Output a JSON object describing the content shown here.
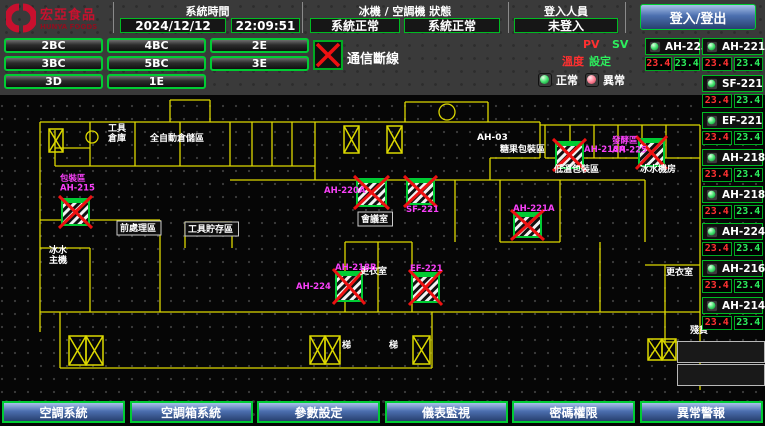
{
  "header": {
    "logo_title": "宏亞食品",
    "logo_subtitle": "HUNYA FOODS",
    "system_time_label": "系統時間",
    "date": "2024/12/12",
    "time": "22:09:51",
    "status_label": "冰機 / 空調機 狀態",
    "chiller_status": "系統正常",
    "ahu_status": "系統正常",
    "login_label": "登入人員",
    "login_status": "未登入",
    "login_button": "登入/登出"
  },
  "nav": {
    "rows": [
      [
        "2BC",
        "4BC",
        "2E"
      ],
      [
        "3BC",
        "5BC",
        "3E"
      ],
      [
        "3D",
        "1E"
      ]
    ]
  },
  "comm_loss_label": "通信斷線",
  "pvsv": {
    "pv": "PV",
    "sv": "SV",
    "temp": "溫度",
    "set": "設定"
  },
  "legend": {
    "normal": "正常",
    "abnormal": "異常"
  },
  "panel": {
    "left_unit": {
      "name": "AH-225",
      "pv": "23.4",
      "sv": "23.4"
    },
    "units": [
      {
        "name": "AH-221A",
        "pv": "23.4",
        "sv": "23.4"
      },
      {
        "name": "SF-221",
        "pv": "23.4",
        "sv": "23.4"
      },
      {
        "name": "EF-221",
        "pv": "23.4",
        "sv": "23.4"
      },
      {
        "name": "AH-218A",
        "pv": "23.4",
        "sv": "23.4"
      },
      {
        "name": "AH-218B",
        "pv": "23.4",
        "sv": "23.4"
      },
      {
        "name": "AH-224",
        "pv": "23.4",
        "sv": "23.4"
      },
      {
        "name": "AH-216",
        "pv": "23.4",
        "sv": "23.4"
      },
      {
        "name": "AH-214",
        "pv": "23.4",
        "sv": "23.4"
      }
    ],
    "empty_slots": 2
  },
  "floorplan": {
    "rooms": [
      {
        "text": "工具\n倉庫",
        "x": 108,
        "y": 131
      },
      {
        "text": "全自動倉儲區",
        "x": 150,
        "y": 141
      },
      {
        "text": "AH-03",
        "x": 477,
        "y": 140
      },
      {
        "text": "糖果包裝區",
        "x": 500,
        "y": 152
      },
      {
        "text": "低溫包裝區",
        "x": 554,
        "y": 172
      },
      {
        "text": "冰水機房",
        "x": 640,
        "y": 172
      },
      {
        "text": "會議室",
        "x": 361,
        "y": 222,
        "boxed": true
      },
      {
        "text": "前處理區",
        "x": 120,
        "y": 231,
        "boxed": true
      },
      {
        "text": "工具貯存區",
        "x": 188,
        "y": 232,
        "boxed": true
      },
      {
        "text": "冰水\n主機",
        "x": 49,
        "y": 253
      },
      {
        "text": "更衣室",
        "x": 360,
        "y": 274
      },
      {
        "text": "更衣室",
        "x": 666,
        "y": 275
      },
      {
        "text": "梯",
        "x": 342,
        "y": 348
      },
      {
        "text": "梯",
        "x": 389,
        "y": 348
      },
      {
        "text": "殘貨",
        "x": 690,
        "y": 333
      }
    ],
    "tags": [
      {
        "text": "包裝區\nAH-215",
        "x": 60,
        "y": 181
      },
      {
        "text": "AH-220A",
        "x": 324,
        "y": 193
      },
      {
        "text": "SF-221",
        "x": 406,
        "y": 212
      },
      {
        "text": "AH-218A",
        "x": 584,
        "y": 152
      },
      {
        "text": "發酵區\nAH-225",
        "x": 612,
        "y": 143
      },
      {
        "text": "AH-221A",
        "x": 513,
        "y": 211
      },
      {
        "text": "AH-224",
        "x": 296,
        "y": 289
      },
      {
        "text": "AH-218B",
        "x": 335,
        "y": 270
      },
      {
        "text": "EF-221",
        "x": 410,
        "y": 271
      }
    ],
    "units": [
      {
        "x": 62,
        "y": 199,
        "w": 27,
        "h": 26
      },
      {
        "x": 357,
        "y": 179,
        "w": 29,
        "h": 27
      },
      {
        "x": 407,
        "y": 179,
        "w": 27,
        "h": 25
      },
      {
        "x": 556,
        "y": 142,
        "w": 27,
        "h": 26
      },
      {
        "x": 639,
        "y": 139,
        "w": 25,
        "h": 27
      },
      {
        "x": 514,
        "y": 213,
        "w": 27,
        "h": 24
      },
      {
        "x": 336,
        "y": 272,
        "w": 26,
        "h": 29
      },
      {
        "x": 412,
        "y": 273,
        "w": 27,
        "h": 29
      }
    ],
    "stairs": [
      {
        "x": 49,
        "y": 129,
        "w": 14,
        "h": 23
      },
      {
        "x": 344,
        "y": 126,
        "w": 15,
        "h": 27
      },
      {
        "x": 387,
        "y": 126,
        "w": 15,
        "h": 27
      },
      {
        "x": 69,
        "y": 336,
        "w": 17,
        "h": 29
      },
      {
        "x": 86,
        "y": 336,
        "w": 17,
        "h": 29
      },
      {
        "x": 310,
        "y": 336,
        "w": 15,
        "h": 28
      },
      {
        "x": 325,
        "y": 336,
        "w": 15,
        "h": 28
      },
      {
        "x": 413,
        "y": 336,
        "w": 17,
        "h": 28
      },
      {
        "x": 648,
        "y": 339,
        "w": 14,
        "h": 21
      },
      {
        "x": 662,
        "y": 339,
        "w": 14,
        "h": 21
      }
    ],
    "circles": [
      {
        "cx": 92,
        "cy": 137,
        "r": 6
      },
      {
        "cx": 447,
        "cy": 112,
        "r": 8
      }
    ],
    "walls": "M40,122 H540 M540,125 H700 M40,122 V332 M700,125 V390 M55,130 V166 M90,122 V166 M135,122 V166 M180,122 V166 M230,122 V166 M252,122 V166 M272,122 V166 M292,122 V166 M315,122 V180 M55,166 H315 M55,148 H90 M170,100 H210 M170,100 V122 M210,100 V122 M405,102 H488 M405,102 V122 M488,102 V122 M540,122 V158 M490,158 H540 M490,158 V180 M545,125 V158 M570,125 V158 M594,125 V158 M618,125 V158 M642,125 V158 M666,125 V158 M545,158 H700 M230,180 H645 M645,180 V242 M40,220 H160 M160,220 V312 M185,222 V248 M185,222 H232 M232,222 V248 M90,248 V312 M40,248 H90 M40,312 H700 M60,312 V368 M60,368 H432 M432,312 V368 M345,242 H412 M345,242 V312 M412,242 V312 M378,242 V312 M455,180 V242 M500,180 V242 M500,242 H560 M560,180 V242 M600,242 V312 M645,265 H700 M665,265 V342 M665,342 H700"
  },
  "footer": {
    "buttons": [
      "空調系統",
      "空調箱系統",
      "參數設定",
      "儀表監視",
      "密碼權限",
      "異常警報"
    ]
  },
  "colors": {
    "accent_green": "#00cc33",
    "alarm_red": "#ee1111",
    "pv_red": "#ff3232",
    "sv_green": "#2dee5d",
    "magenta": "#f840f8",
    "wall_yellow": "#dcd800",
    "logo_red": "#c8102e",
    "panel_blue": "#4c6faf"
  }
}
